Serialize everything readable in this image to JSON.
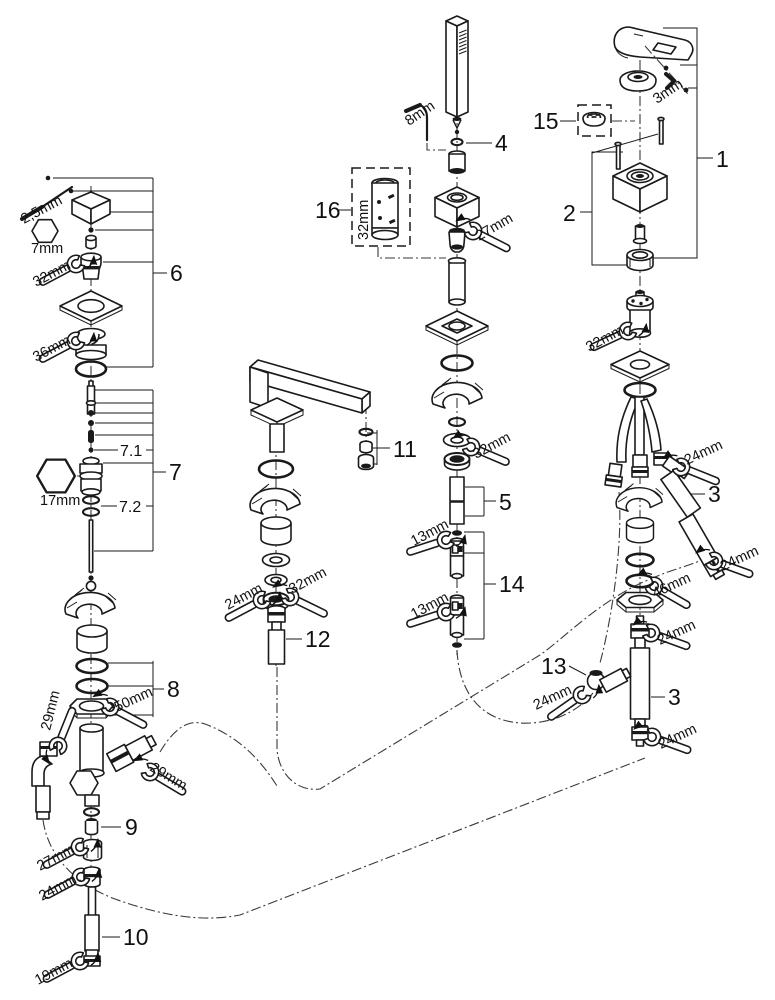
{
  "figure": {
    "type": "exploded-parts-diagram",
    "subject": "four-hole bath/deck faucet spare parts drawing"
  },
  "callouts": {
    "c1": "1",
    "c2": "2",
    "c3_upper": "3",
    "c3_lower": "3",
    "c4": "4",
    "c5": "5",
    "c6": "6",
    "c7": "7",
    "c7_1": "7.1",
    "c7_2": "7.2",
    "c8": "8",
    "c9": "9",
    "c10": "10",
    "c11": "11",
    "c12": "12",
    "c13": "13",
    "c14": "14",
    "c15": "15",
    "c16": "16"
  },
  "sizes": {
    "allen_handle_left": "2,5mm",
    "hex_7": "7mm",
    "w32_cartridge_left": "32mm",
    "w36_flange_left": "36mm",
    "hex_17": "17mm",
    "w50_locknut_left": "50mm",
    "w29_body_left": "29mm",
    "w29_body_right": "29mm",
    "w27_union_left": "27mm",
    "w24_hose_left": "24mm",
    "w19_hose_end_left": "19mm",
    "allen_shower": "8mm",
    "w27_shower_socket": "27mm",
    "w32_shower_locknut": "32mm",
    "w13_checkvalve_upper": "13mm",
    "w13_checkvalve_lower": "13mm",
    "w24_spout_hose": "24mm",
    "w32_spout_locknut": "32mm",
    "tool16_32": "32mm",
    "allen_3_handle": "3mm",
    "w32_cartridge_right": "32mm",
    "w24_elbow_upper": "24mm",
    "w24_hose_mid": "24mm",
    "w46_locknut_right": "46mm",
    "w24_hose_upper": "24mm",
    "w24_elbow_13": "24mm",
    "w24_hose_lower": "24mm"
  }
}
